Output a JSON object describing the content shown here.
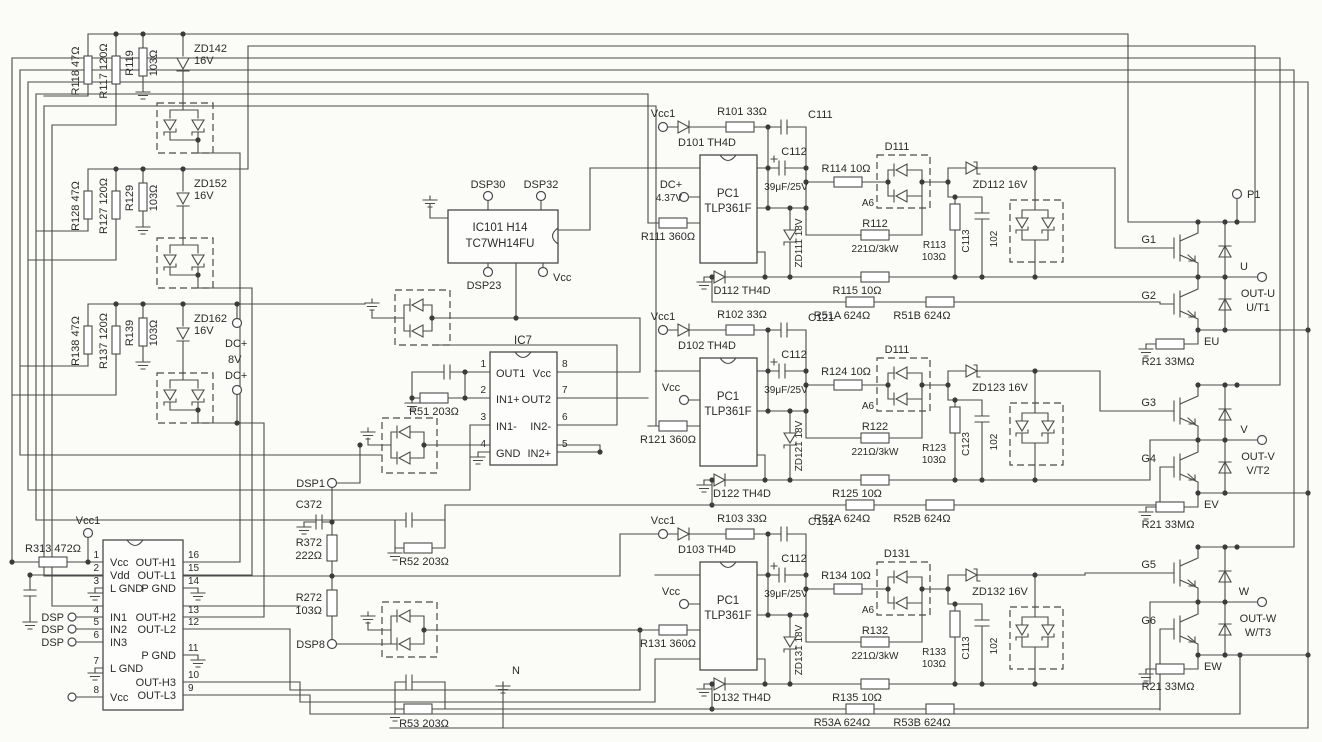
{
  "colors": {
    "ink": "#4a4a4a",
    "paper": "#fbfbf8"
  },
  "groups": [
    {
      "ra": "R118 47Ω",
      "rb": "R117 120Ω",
      "rc": "R119",
      "rcv": "103Ω",
      "zd": "ZD142",
      "zdv": "16V"
    },
    {
      "ra": "R128 47Ω",
      "rb": "R127 120Ω",
      "rc": "R129",
      "rcv": "103Ω",
      "zd": "ZD152",
      "zdv": "16V"
    },
    {
      "ra": "R138 47Ω",
      "rb": "R137 120Ω",
      "rc": "R139",
      "rcv": "103Ω",
      "zd": "ZD162",
      "zdv": "16V"
    }
  ],
  "dc": {
    "a": "DC+",
    "b": "8V",
    "c": "DC+"
  },
  "drv": {
    "vcc1": "Vcc1",
    "r313": "R313 472Ω",
    "dsp": "DSP",
    "pl": [
      [
        "1",
        "Vcc"
      ],
      [
        "2",
        "Vdd"
      ],
      [
        "3",
        "L GND"
      ],
      [
        "4",
        "IN1"
      ],
      [
        "5",
        "IN2"
      ],
      [
        "6",
        "IN3"
      ],
      [
        "7",
        "L GND"
      ],
      [
        "8",
        "Vcc"
      ]
    ],
    "pr": [
      [
        "16",
        "OUT-H1"
      ],
      [
        "15",
        "OUT-L1"
      ],
      [
        "14",
        "P GND"
      ],
      [
        "13",
        "OUT-H2"
      ],
      [
        "12",
        "OUT-L2"
      ],
      [
        "11",
        "P GND"
      ],
      [
        "10",
        "OUT-H3"
      ],
      [
        "9",
        "OUT-L3"
      ]
    ]
  },
  "ic101": {
    "t1": "DSP30",
    "t2": "DSP32",
    "name": "IC101 H14",
    "part": "TC7WH14FU",
    "b1": "DSP23",
    "b2": "Vcc"
  },
  "ic7": {
    "name": "IC7",
    "r51": "R51 203Ω",
    "pl": [
      [
        "1",
        "OUT1"
      ],
      [
        "2",
        "IN1+"
      ],
      [
        "3",
        "IN1-"
      ],
      [
        "4",
        "GND"
      ]
    ],
    "pr": [
      [
        "8",
        "Vcc"
      ],
      [
        "7",
        "OUT2"
      ],
      [
        "6",
        "IN2-"
      ],
      [
        "5",
        "IN2+"
      ]
    ]
  },
  "mid": {
    "dsp1": "DSP1",
    "c372": "C372",
    "r372a": "R372",
    "r372b": "222Ω",
    "r272a": "R272",
    "r272b": "103Ω",
    "dsp8": "DSP8",
    "r52": "R52 203Ω",
    "r53": "R53 203Ω",
    "n": "N"
  },
  "ch": [
    {
      "vcc": "Vcc1",
      "din": "D101 TH4D",
      "rin": "R101 33Ω",
      "ca": "C111",
      "cb": "C112",
      "cbv": "39μF/25V",
      "sup1": "DC+",
      "sup2": "4.37V",
      "opto1": "PC1",
      "opto2": "TLP361F",
      "rdrv": "R111 360Ω",
      "zd18": "ZD111 18V",
      "dlow": "D112 TH4D",
      "rg": "R114 10Ω",
      "dp": "D111",
      "dps": "A6",
      "rp1": "R112",
      "rp2": "221Ω/3kW",
      "rs1": "R113",
      "rs2": "103Ω",
      "zd16": "ZD112 16V",
      "cs": "C113",
      "csv": "102",
      "rl": "R115 10Ω",
      "rda": "R51A 624Ω",
      "rdb": "R51B 624Ω"
    },
    {
      "vcc": "Vcc1",
      "din": "D102 TH4D",
      "rin": "R102 33Ω",
      "ca": "C121",
      "cb": "C112",
      "cbv": "39μF/25V",
      "sup1": "Vcc",
      "sup2": "",
      "opto1": "PC1",
      "opto2": "TLP361F",
      "rdrv": "R121 360Ω",
      "zd18": "ZD121 18V",
      "dlow": "D122 TH4D",
      "rg": "R124 10Ω",
      "dp": "D111",
      "dps": "A6",
      "rp1": "R122",
      "rp2": "221Ω/3kW",
      "rs1": "R123",
      "rs2": "103Ω",
      "zd16": "ZD123 16V",
      "cs": "C123",
      "csv": "102",
      "rl": "R125 10Ω",
      "rda": "R52A 624Ω",
      "rdb": "R52B 624Ω"
    },
    {
      "vcc": "Vcc1",
      "din": "D103 TH4D",
      "rin": "R103 33Ω",
      "ca": "C131",
      "cb": "C112",
      "cbv": "39μF/25V",
      "sup1": "Vcc",
      "sup2": "",
      "opto1": "PC1",
      "opto2": "TLP361F",
      "rdrv": "R131 360Ω",
      "zd18": "ZD131 18V",
      "dlow": "D132 TH4D",
      "rg": "R134 10Ω",
      "dp": "D131",
      "dps": "A6",
      "rp1": "R132",
      "rp2": "221Ω/3kW",
      "rs1": "R133",
      "rs2": "103Ω",
      "zd16": "ZD132 16V",
      "cs": "C113",
      "csv": "102",
      "rl": "R135 10Ω",
      "rda": "R53A 624Ω",
      "rdb": "R53B 624Ω"
    }
  ],
  "legs": [
    {
      "top": "P1",
      "gh": "G1",
      "gl": "G2",
      "ph": "U",
      "out": "OUT-U",
      "out2": "U/T1",
      "e": "EU",
      "sh": "R21 33MΩ"
    },
    {
      "gh": "G3",
      "gl": "G4",
      "ph": "V",
      "out": "OUT-V",
      "out2": "V/T2",
      "e": "EV",
      "sh": "R21 33MΩ"
    },
    {
      "gh": "G5",
      "gl": "G6",
      "ph": "W",
      "out": "OUT-W",
      "out2": "W/T3",
      "e": "EW",
      "sh": "R21 33MΩ"
    }
  ]
}
